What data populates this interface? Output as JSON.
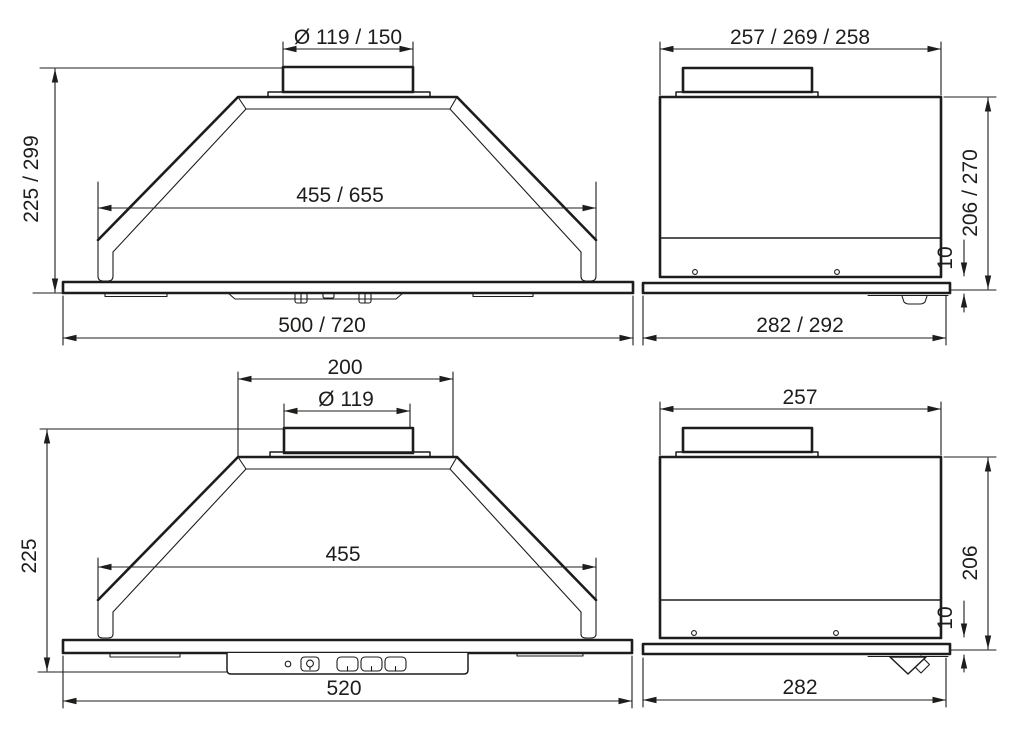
{
  "colors": {
    "line": "#1d1d1b",
    "background": "#ffffff"
  },
  "views": {
    "front_large": {
      "duct_diameter": "Ø 119 / 150",
      "height": "225 / 299",
      "inner_width": "455 / 655",
      "total_width": "500 / 720"
    },
    "side_large": {
      "top_depth": "257 / 269 / 258",
      "body_height": "206 / 270",
      "bottom_lip": "10",
      "total_depth": "282 / 292"
    },
    "front_small": {
      "top_width": "200",
      "duct_diameter": "Ø 119",
      "height": "225",
      "inner_width": "455",
      "total_width": "520"
    },
    "side_small": {
      "top_depth": "257",
      "body_height": "206",
      "bottom_lip": "10",
      "total_depth": "282"
    }
  }
}
